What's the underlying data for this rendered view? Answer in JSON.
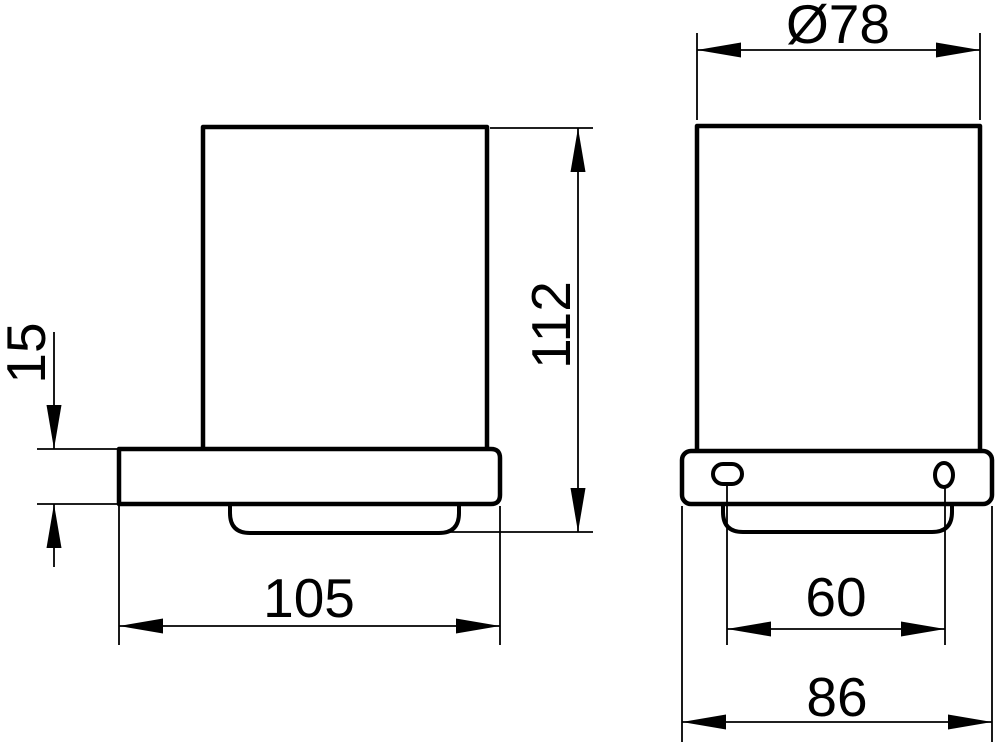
{
  "theme": {
    "line": "#000000",
    "bg": "#ffffff"
  },
  "drawing": {
    "kind": "technical-dimension-drawing",
    "views": {
      "side": {
        "dims": {
          "bracket_thickness": "15",
          "tumbler_height": "112",
          "mount_depth": "105"
        }
      },
      "front": {
        "dims": {
          "tumbler_diameter": "Ø78",
          "hole_spacing": "60",
          "holder_width": "86"
        }
      }
    }
  }
}
